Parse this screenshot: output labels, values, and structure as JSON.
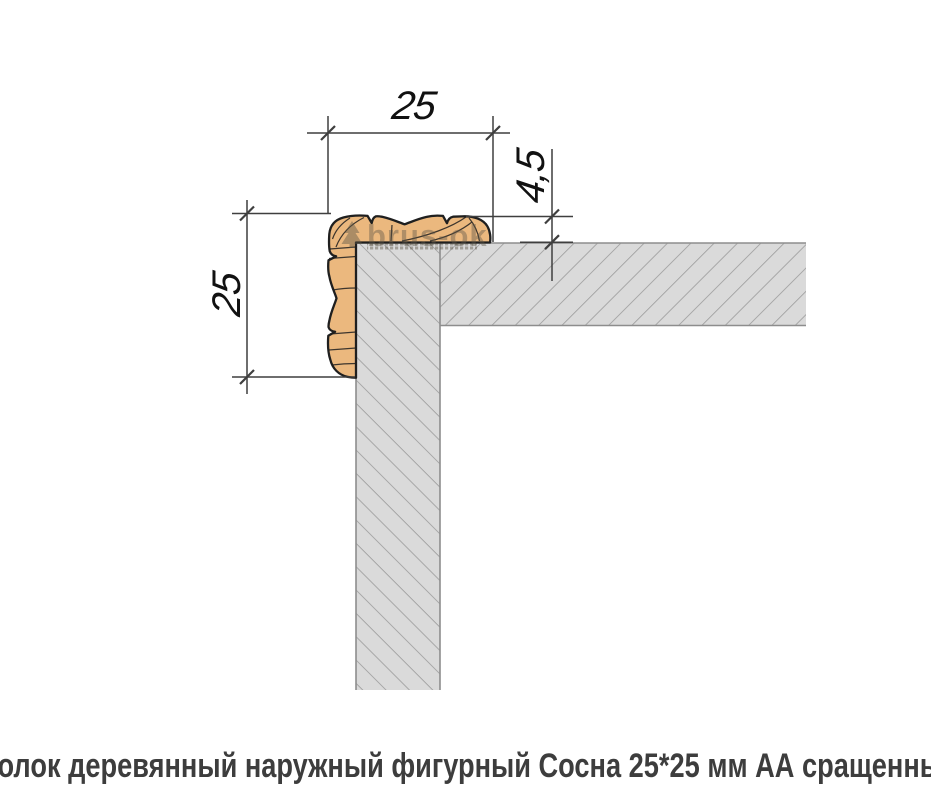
{
  "colors": {
    "wood_fill": "#EBB87E",
    "wood_outline": "#1F1F1F",
    "panel_fill": "#DADADA",
    "panel_edge": "#8D8D8D",
    "hatch_line": "#9B9B9B",
    "dim_line": "#3F3F3F",
    "dim_text": "#111111",
    "watermark_color": "#5E5648",
    "caption_color": "#3D3D3D",
    "background": "#FFFFFF"
  },
  "drawing": {
    "dimensions": {
      "top_width": "25",
      "left_height": "25",
      "profile_thickness": "4,5"
    },
    "watermark": {
      "brand": "brus-ok"
    }
  },
  "caption": {
    "text": "Уголок деревянный наружный фигурный Сосна 25*25 мм АА сращенный"
  }
}
